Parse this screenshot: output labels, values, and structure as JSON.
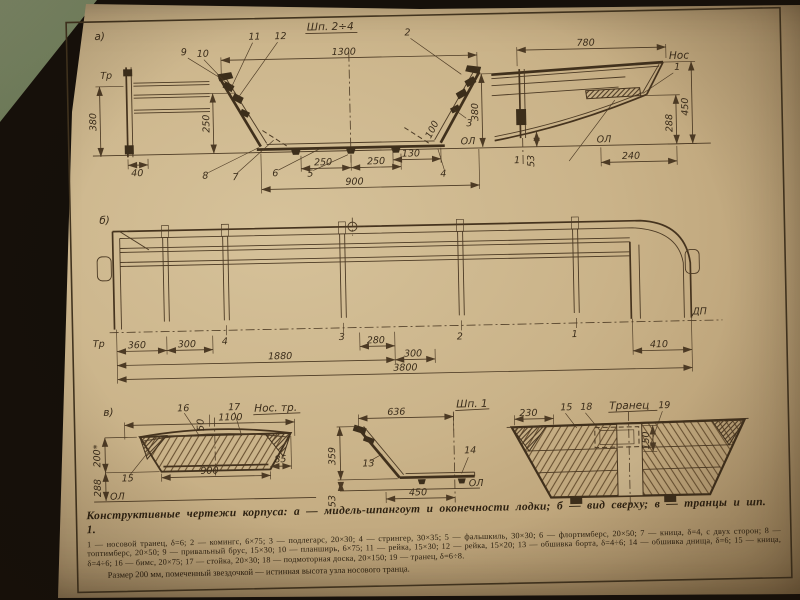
{
  "palette": {
    "paper": "#c9b389",
    "ink": "#4c3a24",
    "felt_green": "#71815d",
    "shadow": "#15100a"
  },
  "page": {
    "caption": "Конструктивные чертежи корпуса: а — мидель-шпангоут и оконечности лодки; б — вид сверху; в — транцы и шп. 1.",
    "legend": "1 — носовой транец, δ=6; 2 — комингс, 6×75; 3 — подлегарс, 20×30; 4 — стрингер, 30×35; 5 — фальшкиль, 30×30; 6 — флортимберс, 20×50; 7 — кница, δ=4, с двух сторон; 8 — топтимберс, 20×50; 9 — привальный брус, 15×30; 10 — планширь, 6×75; 11 — рейка, 15×30; 12 — рейка, 15×20; 13 — обшивка борта, δ=4÷6; 14 — обшивка днища, δ=6; 15 — кница, δ=4÷6; 16 — бимс, 20×75; 17 — стойка, 20×30; 18 — подмоторная доска, 20×150; 19 — транец, δ=6÷8.",
    "note": "Размер 200 мм, помеченный звездочкой — истинная высота узла носового транца."
  },
  "midship": {
    "panel": "а)",
    "title": "Шп. 2÷4",
    "tr": "Тр",
    "ol": "ОЛ",
    "d380": "380",
    "d40": "40",
    "d250v": "250",
    "d1300": "1300",
    "d250a": "250",
    "d250b": "250",
    "d900": "900",
    "d130": "130",
    "d100": "100",
    "n2": "2",
    "n3": "3",
    "n4": "4",
    "n5": "5",
    "n6": "6",
    "n7": "7",
    "n8": "8",
    "n9": "9",
    "n10": "10",
    "n11": "11",
    "n12": "12"
  },
  "bow_profile": {
    "d780": "780",
    "nos": "Нос",
    "n1": "1",
    "d380": "380",
    "d288": "288",
    "d450": "450",
    "d240": "240",
    "d53": "53",
    "f1": "1",
    "ol": "ОЛ"
  },
  "plan": {
    "panel": "б)",
    "tr": "Тр",
    "dp": "ДП",
    "f4": "4",
    "f3": "3",
    "f2": "2",
    "f1": "1",
    "d360": "360",
    "d300a": "300",
    "d280": "280",
    "d1880": "1880",
    "d300b": "300",
    "d3800": "3800",
    "d410": "410"
  },
  "bow_transom": {
    "panel": "в)",
    "title": "Нос. тр.",
    "n16": "16",
    "n17": "17",
    "n15": "15",
    "d1100": "1100",
    "d50": "50",
    "d200": "200*",
    "d288": "288",
    "d900": "900",
    "d85": "85",
    "ol": "ОЛ"
  },
  "frame1": {
    "title": "Шп. 1",
    "d636": "636",
    "d359": "359",
    "d450": "450",
    "d53": "53",
    "n13": "13",
    "n14": "14",
    "ol": "ОЛ"
  },
  "stern_transom": {
    "title": "Транец",
    "d230": "230",
    "n15": "15",
    "n18": "18",
    "n19": "19",
    "d150": "150"
  }
}
